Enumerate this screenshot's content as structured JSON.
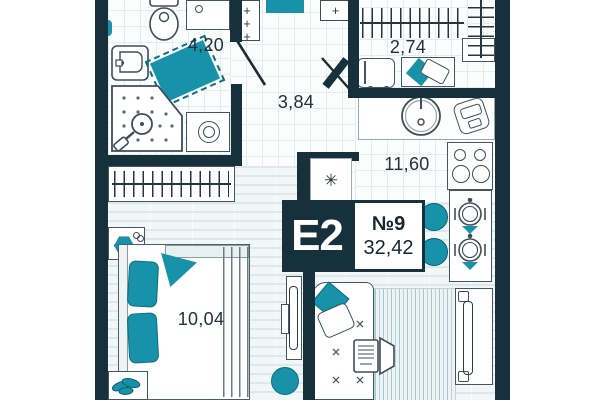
{
  "apartment": {
    "type_label": "E2",
    "unit_number": "№9",
    "total_area": "32,42"
  },
  "rooms": {
    "bathroom": {
      "name": "bathroom",
      "area": "4,20"
    },
    "wardrobe": {
      "name": "wardrobe",
      "area": "2,74"
    },
    "hallway": {
      "name": "hallway",
      "area": "3,84"
    },
    "kitchen_living": {
      "name": "kitchen-living",
      "area": "11,60"
    },
    "bedroom": {
      "name": "bedroom",
      "area": "10,04"
    }
  },
  "symbols": {
    "vent": "✳",
    "plus": "+"
  },
  "colors": {
    "wall": "#16313c",
    "accent": "#1792a8",
    "outline": "#44565e",
    "floor_line": "#e3ecee"
  }
}
